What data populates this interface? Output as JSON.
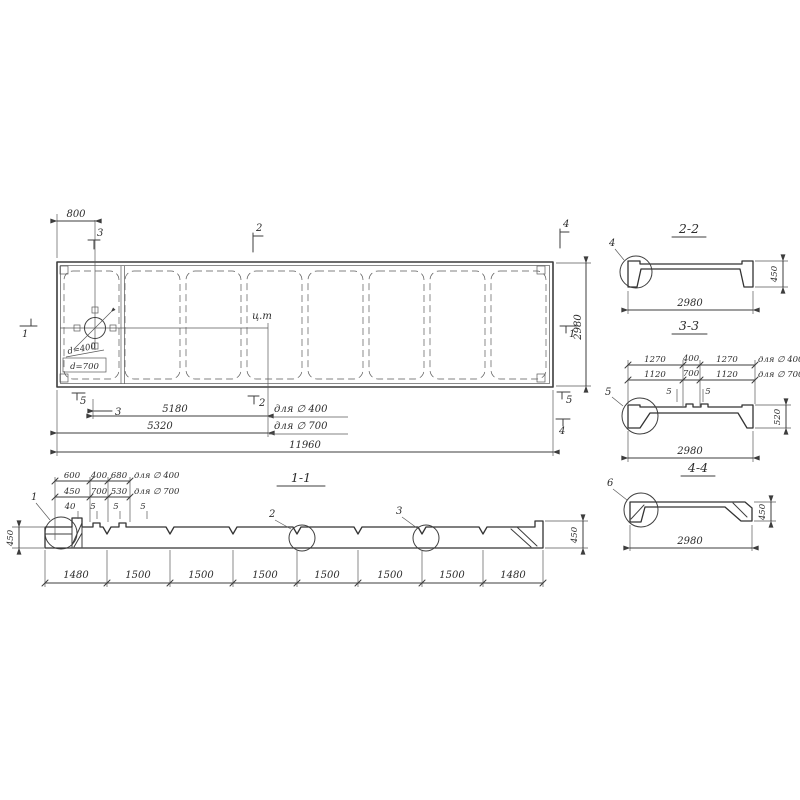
{
  "plan": {
    "dim_800": "800",
    "dim_2980": "2980",
    "dim_5180": "5180",
    "dim_5320": "5320",
    "dim_11960": "11960",
    "note_5180": "для ∅ 400",
    "note_5320": "для ∅ 700",
    "hole_d400": "d=400",
    "hole_d700": "d=700",
    "ct": "ц.т",
    "m_top_3": "3",
    "m_top_2": "2",
    "m_top_4": "4",
    "m_left_1": "1",
    "m_right_1": "1",
    "m_bot_5l": "5",
    "m_bot_3": "3",
    "m_bot_2": "2",
    "m_bot_5r": "5",
    "m_bot_4": "4"
  },
  "s11": {
    "title": "1-1",
    "r1": [
      "600",
      "400",
      "680"
    ],
    "r1n": "для ∅ 400",
    "r2": [
      "450",
      "700",
      "530"
    ],
    "r2n": "для ∅ 700",
    "r3": [
      "40",
      "5",
      "5",
      "5"
    ],
    "bottom": [
      "1480",
      "1500",
      "1500",
      "1500",
      "1500",
      "1500",
      "1500",
      "1480"
    ],
    "h_left": "450",
    "h_right": "450",
    "d1": "1",
    "d2": "2",
    "d3": "3"
  },
  "s22": {
    "title": "2-2",
    "d": "4",
    "w": "2980",
    "h": "450"
  },
  "s33": {
    "title": "3-3",
    "d": "5",
    "w": "2980",
    "h": "520",
    "r1": [
      "1270",
      "400",
      "1270"
    ],
    "r1n": "для ∅ 400",
    "r2": [
      "1120",
      "700",
      "1120"
    ],
    "r2n": "для ∅ 700",
    "r3": [
      "5",
      "5"
    ]
  },
  "s44": {
    "title": "4-4",
    "d": "6",
    "w": "2980",
    "h": "450"
  }
}
